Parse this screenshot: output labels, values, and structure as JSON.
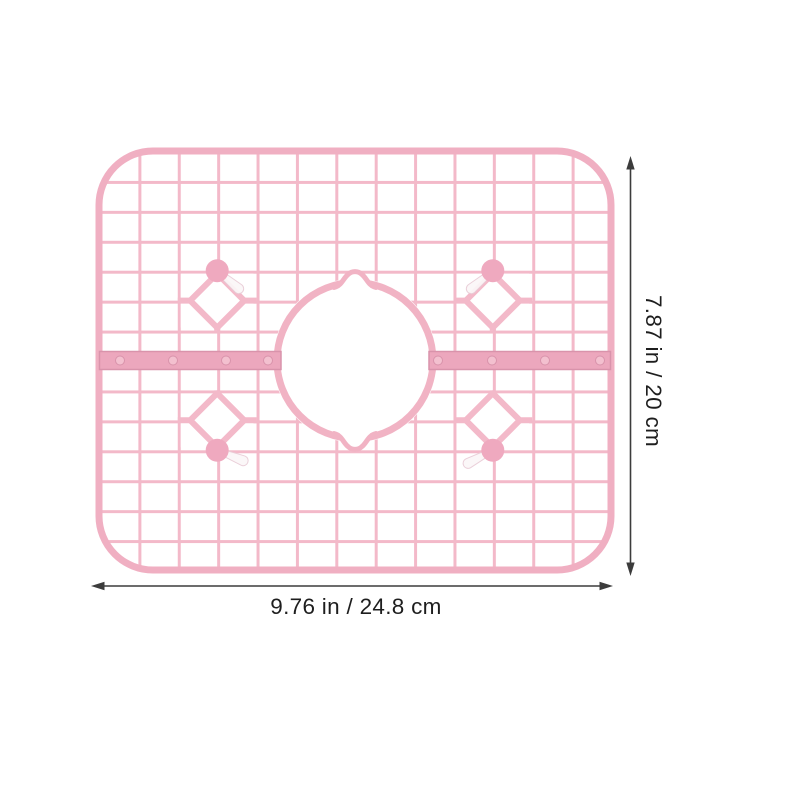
{
  "theme": {
    "bg": "#ffffff",
    "grid-pink": "#f3b9c9",
    "grid-border": "#f0afc2",
    "ring-pink": "#f1b3c4",
    "bar-fill": "#eca7bd",
    "bar-stroke": "#d993ab",
    "rivet-fill": "#f3c0cf",
    "knob-fill": "#efa9bf",
    "prong-fill": "#fbf7f8",
    "prong-stroke": "#e9ccd6",
    "dim-line": "#3c3c3c",
    "label-text": "#1e1e1e"
  },
  "product": {
    "kind": "pink sink protector grid mat",
    "grid_columns": 13,
    "grid_rows": 14,
    "suction_pegs": 4,
    "diamond_ornaments": 4,
    "mounting_bars": 2,
    "rivets_per_bar": 4,
    "center_drain_hole": true
  },
  "annotations": {
    "width_label": "9.76 in / 24.8 cm",
    "height_label": "7.87 in / 20 cm"
  }
}
